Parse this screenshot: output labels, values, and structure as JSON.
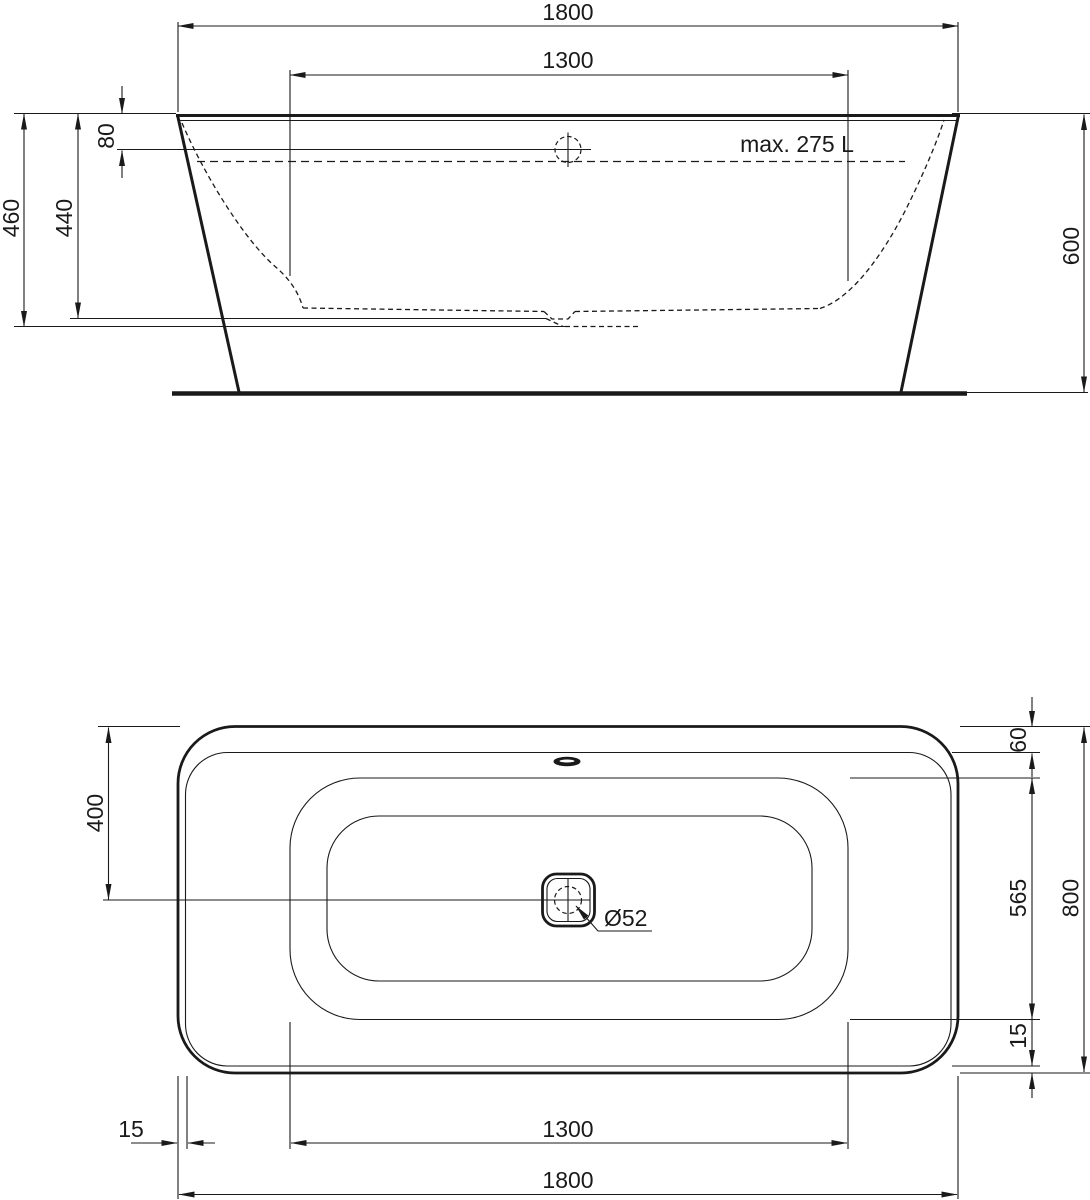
{
  "drawing_title": "bathtub-technical-drawing",
  "side_view": {
    "dim_overall_length": "1800",
    "dim_inner_length": "1300",
    "dim_overflow_offset": "80",
    "dim_outer_height": "460",
    "dim_inner_depth": "440",
    "dim_total_height": "600",
    "capacity_note": "max. 275 L"
  },
  "plan_view": {
    "dim_center_offset": "400",
    "dim_head_rim_width": "60",
    "dim_basin_inner_width": "565",
    "dim_rim_lip_right": "15",
    "dim_overall_width": "800",
    "dim_rim_lip_left": "15",
    "dim_basin_inner_length": "1300",
    "dim_overall_length": "1800",
    "drain_diameter": "Ø52"
  },
  "colors": {
    "ink": "#1a1a1a",
    "paper": "#ffffff"
  }
}
